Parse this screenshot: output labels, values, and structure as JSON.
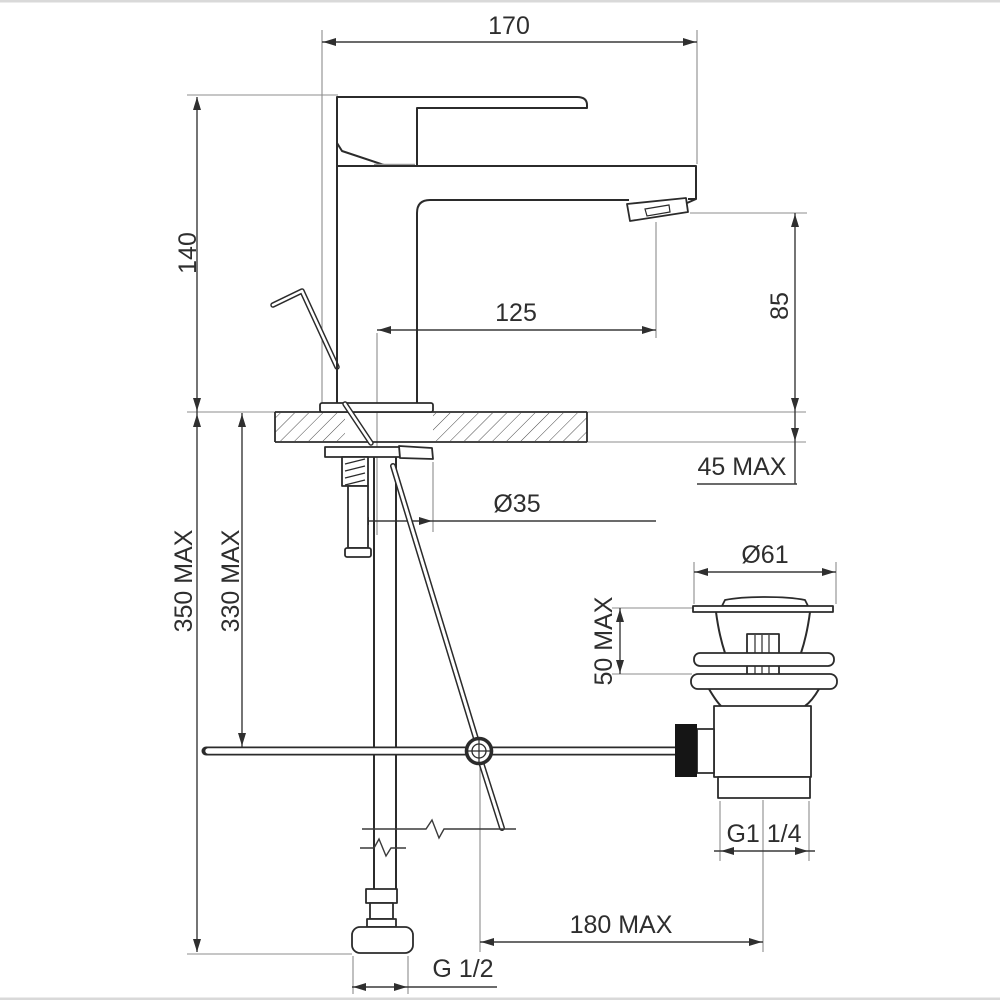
{
  "drawing": {
    "title": "Basin mixer tap with pop-up waste - installation dimension drawing",
    "units": "mm",
    "line_color": "#2b2b2b",
    "background_color": "#ffffff",
    "labels": {
      "spout_depth": "170",
      "height_above_deck": "140",
      "spout_reach": "125",
      "spout_outlet_height": "85",
      "deck_thickness_max": "45 MAX",
      "tap_hole_diameter": "Ø35",
      "hose_length_max": "350 MAX",
      "rod_length_max": "330 MAX",
      "waste_flange_diameter": "Ø61",
      "waste_above_basin_max": "50 MAX",
      "waste_thread": "G1 1/4",
      "rod_to_waste_offset_max": "180 MAX",
      "supply_thread": "G 1/2"
    }
  }
}
